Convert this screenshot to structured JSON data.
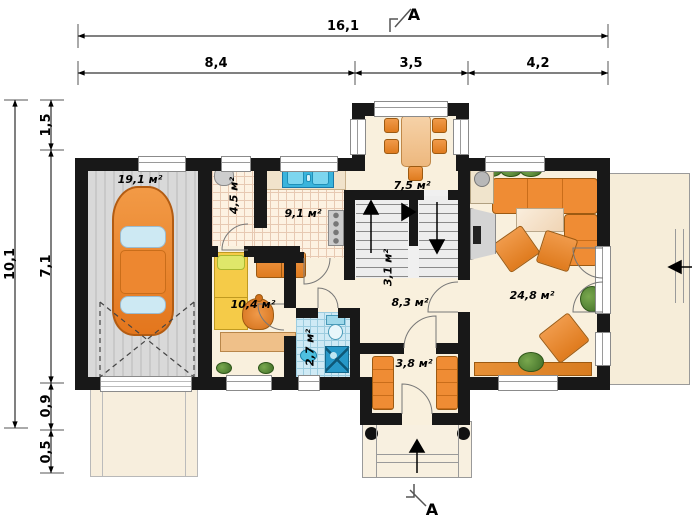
{
  "dimensions": {
    "top_total": "16,1",
    "top_segments": [
      "8,4",
      "3,5",
      "4,2"
    ],
    "left_total": "10,1",
    "left_segments": [
      "1,5",
      "7,1",
      "0,9",
      "0,5"
    ]
  },
  "section_markers": {
    "top": "A",
    "bottom": "A"
  },
  "rooms": {
    "garage": "19,1 м²",
    "pantry": "4,5 м²",
    "kitchen": "9,1 м²",
    "dining": "7,5 м²",
    "stairs": "3,1 м²",
    "hall": "8,3 м²",
    "bedroom": "10,4 м²",
    "bathroom": "2,7 м²",
    "vestibule": "3,8 м²",
    "living_room": "24,8 м²"
  },
  "colors": {
    "wall": "#181818",
    "floor": "#f9f0dd",
    "furniture_accent": "#e98b3e",
    "bed_yellow": "#f5cb48",
    "water_blue": "#3ab4dc",
    "garage_floor": "#d6d6d6",
    "bath_tile": "#cfeaf5"
  }
}
